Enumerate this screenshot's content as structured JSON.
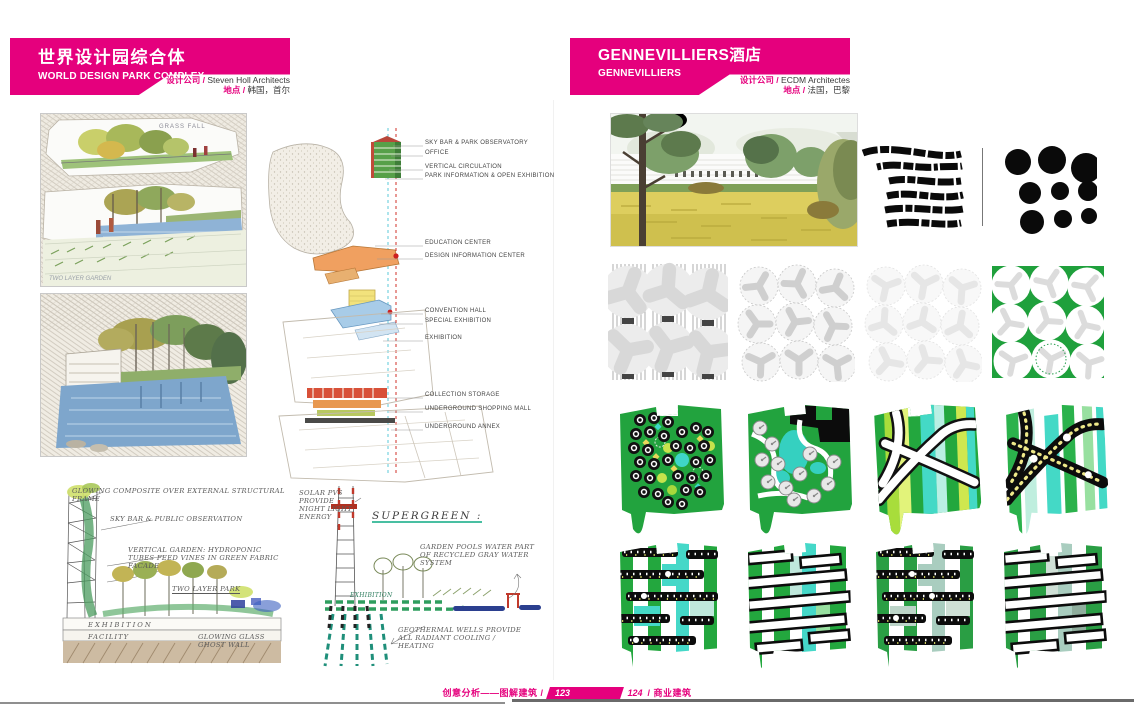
{
  "colors": {
    "accent": "#e5007d",
    "green": "#21a038",
    "cyan": "#44d9c6",
    "lime": "#bfe14e",
    "black": "#111111"
  },
  "left_page": {
    "title_cn": "世界设计园综合体",
    "title_en": "WORLD DESIGN PARK COMPLEX",
    "firm_label": "设计公司 /",
    "firm": "Steven Holl Architects",
    "location_label": "地点 /",
    "location": "韩国，首尔",
    "sketch1_label": "GRASS FALL",
    "sketch1_note": "TWO LAYER GARDEN",
    "axon_labels": [
      "SKY BAR & PARK OBSERVATORY",
      "OFFICE",
      "VERTICAL CIRCULATION",
      "PARK INFORMATION & OPEN EXHIBITION",
      "EDUCATION CENTER",
      "DESIGN INFORMATION CENTER",
      "CONVENTION HALL",
      "SPECIAL EXHIBITION",
      "EXHIBITION",
      "COLLECTION STORAGE",
      "UNDERGROUND SHOPPING MALL",
      "UNDERGROUND ANNEX"
    ],
    "notes_a": {
      "frame": "GLOWING COMPOSITE OVER EXTERNAL STRUCTURAL FRAME",
      "skybar": "SKY BAR & PUBLIC OBSERVATION",
      "garden": "VERTICAL GARDEN: HYDROPONIC TUBES FEED VINES IN GREEN FABRIC FACADE",
      "twolayer": "TWO LAYER PARK",
      "exhibition": "EXHIBITION",
      "facility": "FACILITY",
      "ghostwall": "GLOWING GLASS GHOST WALL"
    },
    "notes_b": {
      "solar": "SOLAR PVS PROVIDE NIGHT LIGHT ENERGY",
      "supergreen": "SUPERGREEN :",
      "pools": "GARDEN POOLS WATER PART OF RECYCLED GRAY WATER SYSTEM",
      "exhibition": "EXHIBITION",
      "geothermal": "GEOTHERMAL WELLS PROVIDE ALL RADIANT COOLING / HEATING"
    }
  },
  "right_page": {
    "title_cn": "GENNEVILLIERS酒店",
    "title_en": "GENNEVILLIERS",
    "firm_label": "设计公司 /",
    "firm": "ECDM Architectes",
    "location_label": "地点 /",
    "location": "法国，巴黎"
  },
  "footer": {
    "series": "创意分析——图解建筑 /",
    "page_left": "123",
    "page_right": "124",
    "category": "/ 商业建筑"
  }
}
